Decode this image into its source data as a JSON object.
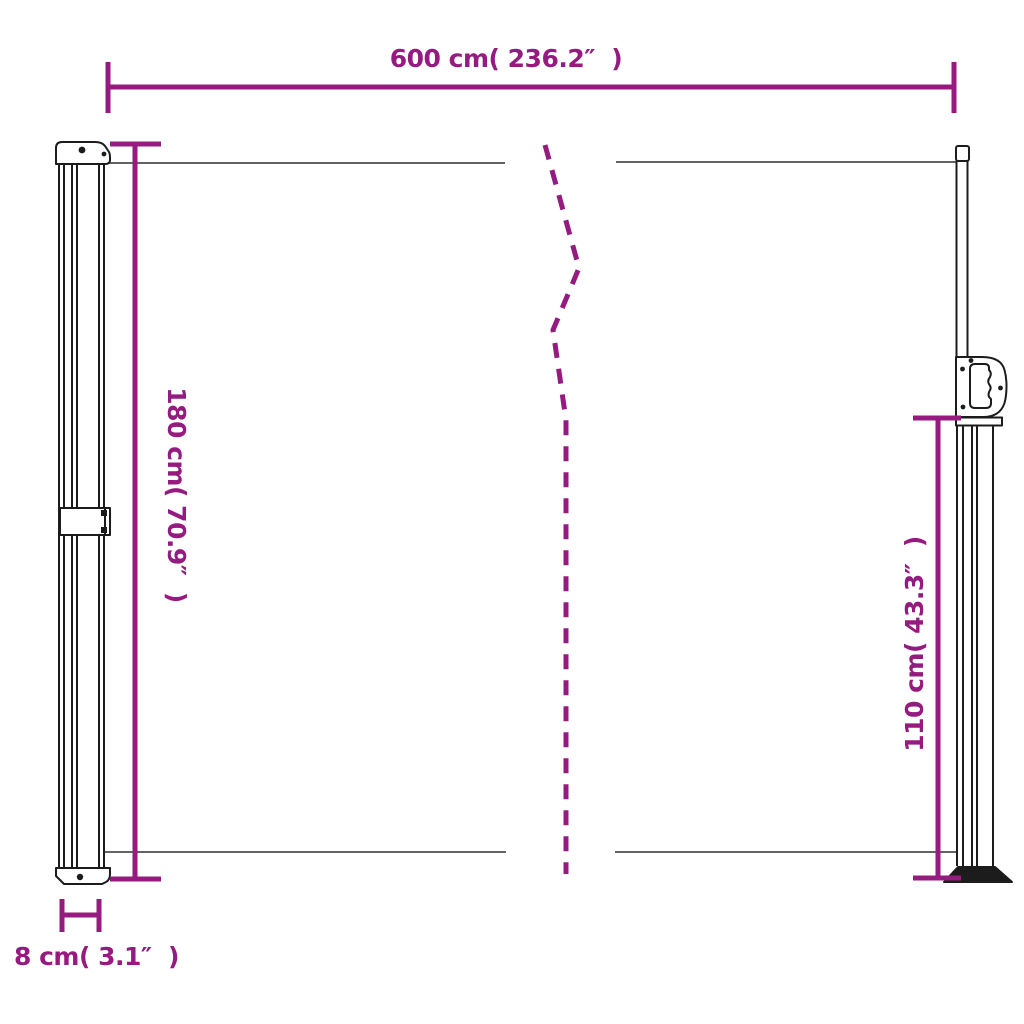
{
  "diagram": {
    "type": "product-dimension-drawing",
    "background": "#ffffff",
    "colors": {
      "dimension_lines_and_text": "#951b81",
      "structure_outline": "#1c1c1c",
      "fabric_edge_line": "#4d4d4d"
    },
    "dimensions": {
      "width": {
        "label": "600 cm( 236.2″  )",
        "cm": 600,
        "inches": 236.2
      },
      "left_height": {
        "label": "180 cm( 70.9″  )",
        "cm": 180,
        "inches": 70.9
      },
      "right_height": {
        "label": "110 cm( 43.3″  )",
        "cm": 110,
        "inches": 43.3
      },
      "depth": {
        "label": "8 cm( 3.1″  )",
        "cm": 8,
        "inches": 3.1
      }
    }
  }
}
